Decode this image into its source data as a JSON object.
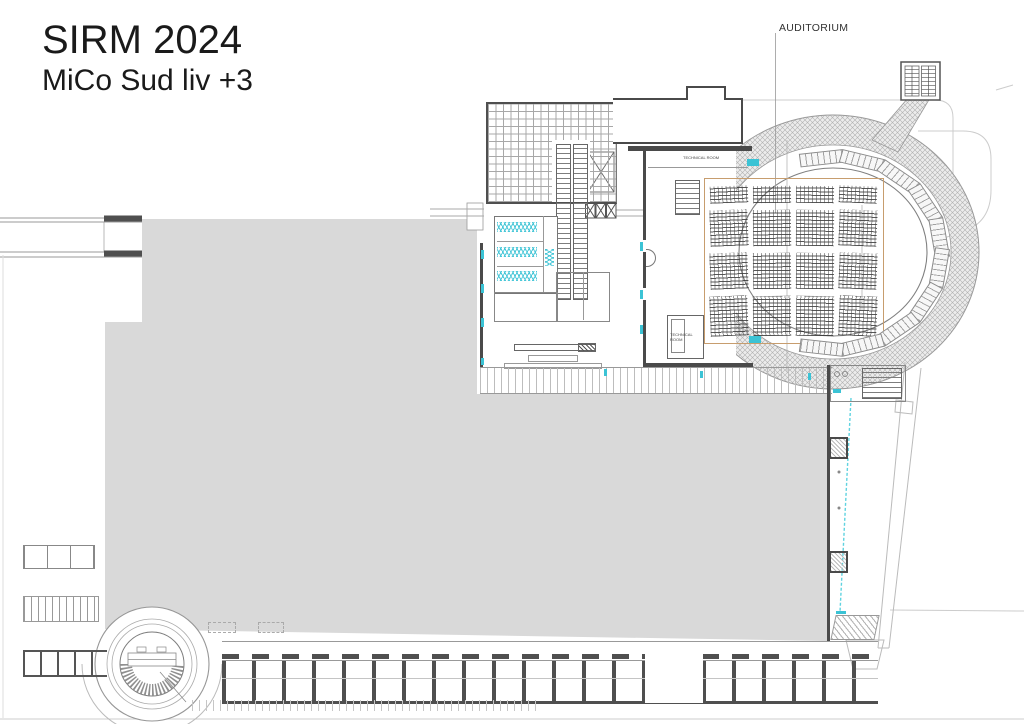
{
  "title": {
    "line1": "SIRM 2024",
    "line2": "MiCo Sud liv +3"
  },
  "annotations": {
    "auditorium_label": "AUDITORIUM",
    "technical_room_upper": "TECHNICAL ROOM",
    "technical_room_lower": "TECHNICAL ROOM"
  },
  "colors": {
    "hall_fill": "#d9d9d9",
    "wall": "#4a4a4a",
    "door_accent": "#3bc3d5",
    "seating_boundary": "#c79d6e",
    "crosshatch": "#b0b0b0",
    "site_line": "#cccccc"
  }
}
